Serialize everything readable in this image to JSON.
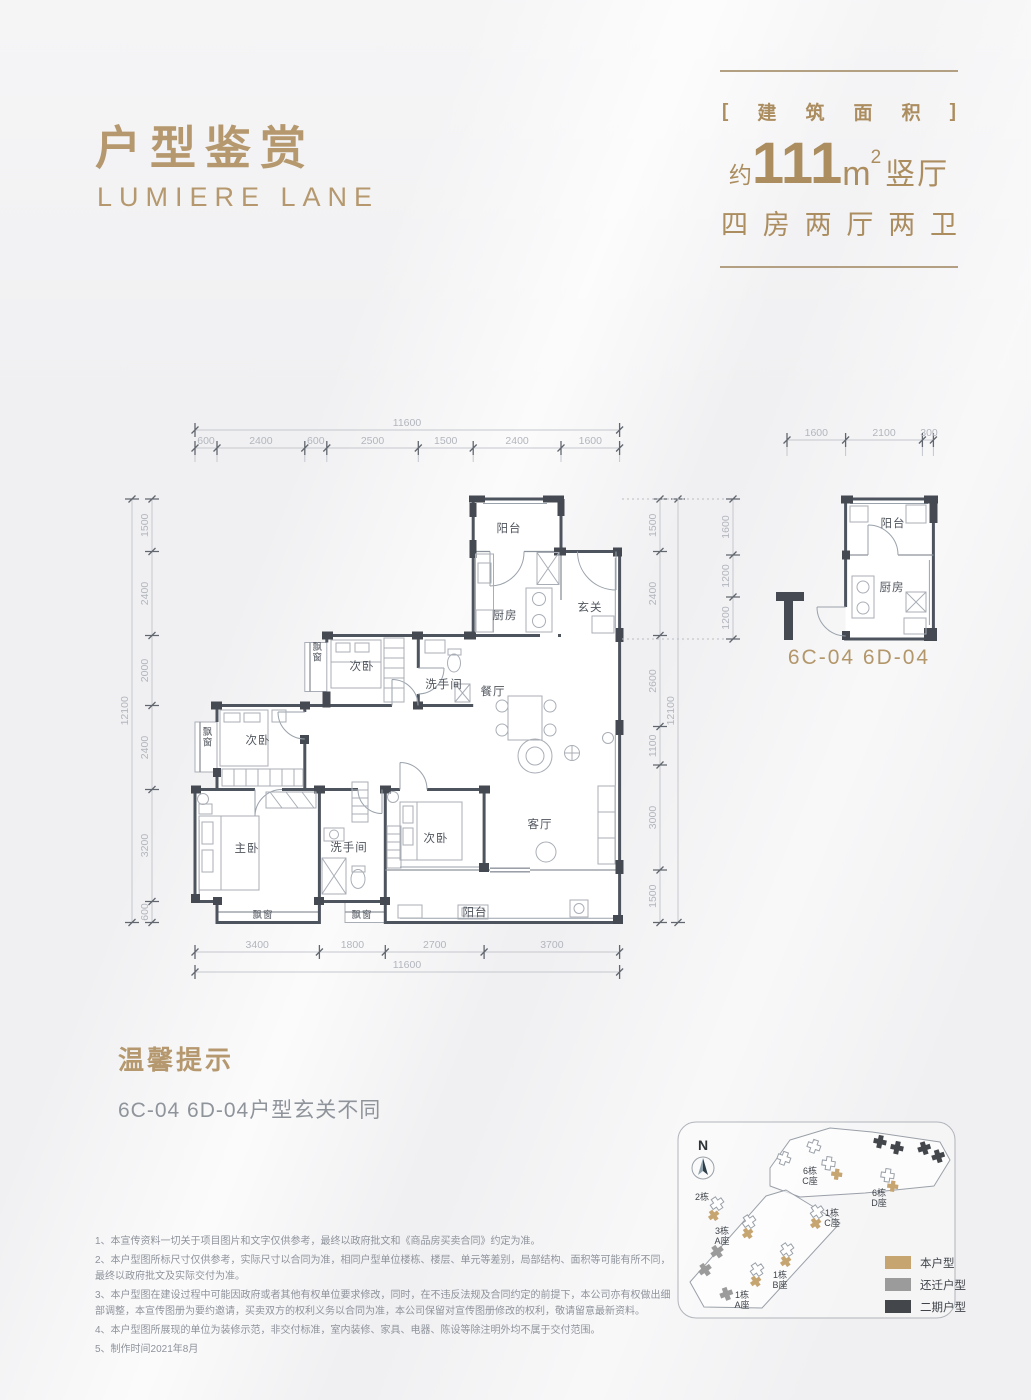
{
  "header": {
    "title": "户型鉴赏",
    "subtitle": "LUMIERE  LANE"
  },
  "info": {
    "bracket_open": "[",
    "bracket_close": "]",
    "area_chars": [
      "建",
      "筑",
      "面",
      "积"
    ],
    "approx": "约",
    "area": "111",
    "unit": "m",
    "sup": "2",
    "hall": "竖厅",
    "layout_chars": [
      "四",
      "房",
      "两",
      "厅",
      "两",
      "卫"
    ]
  },
  "main_plan": {
    "top_total": "11600",
    "top_segs": [
      "600",
      "2400",
      "600",
      "2500",
      "1500",
      "2400",
      "1600"
    ],
    "bottom_total": "11600",
    "bottom_segs": [
      "3400",
      "1800",
      "2700",
      "3700"
    ],
    "left_total": "12100",
    "left_segs": [
      "1500",
      "2400",
      "2000",
      "2400",
      "3200",
      "600"
    ],
    "right_total": "12100",
    "right_segs": [
      "1500",
      "2400",
      "2600",
      "1100",
      "3000",
      "1500"
    ],
    "rooms": {
      "balcony_top": "阳台",
      "kitchen": "厨房",
      "foyer": "玄关",
      "bedroom_upper": "次卧",
      "bay_upper": "飘窗",
      "bath_upper": "洗手间",
      "dining": "餐厅",
      "bedroom_left": "次卧",
      "bay_left": "飘窗",
      "master": "主卧",
      "bath_lower": "洗手间",
      "bedroom_lower": "次卧",
      "living": "客厅",
      "balcony_bottom": "阳台",
      "bay_bottom1": "飘窗",
      "bay_bottom2": "飘窗"
    }
  },
  "small_plan": {
    "top_segs": [
      "1600",
      "2100",
      "300"
    ],
    "left_segs": [
      "1600",
      "1200",
      "1200"
    ],
    "rooms": {
      "balcony": "阳台",
      "kitchen": "厨房"
    },
    "caption": "6C-04  6D-04"
  },
  "tips": {
    "title": "温馨提示",
    "body": "6C-04  6D-04户型玄关不同"
  },
  "notes": [
    "1、本宣传资料一切关于项目图片和文字仅供参考，最终以政府批文和《商品房买卖合同》约定为准。",
    "2、本户型图所标尺寸仅供参考，实际尺寸以合同为准，相同户型单位楼栋、楼层、单元等差别，局部结构、面积等可能有所不同，最终以政府批文及实际交付为准。",
    "3、本户型图在建设过程中可能因政府或者其他有权单位要求修改，同时，在不违反法规及合同约定的前提下，本公司亦有权做出细部调整，本宣传图册为要约邀请，买卖双方的权利义务以合同为准，本公司保留对宣传图册修改的权利，敬请留意最新资料。",
    "4、本户型图所展现的单位为装修示范，非交付标准，室内装修、家具、电器、陈设等除注明外均不属于交付范围。",
    "5、制作时间2021年8月"
  ],
  "sitemap": {
    "north": "N",
    "buildings": {
      "b6c": [
        "6栋",
        "C座"
      ],
      "b6d": [
        "6栋",
        "D座"
      ],
      "b2": "2栋",
      "b1c": [
        "1栋",
        "C座"
      ],
      "b3a": [
        "3栋",
        "A座"
      ],
      "b1b": [
        "1栋",
        "B座"
      ],
      "b1a": [
        "1栋",
        "A座"
      ]
    },
    "legend": [
      {
        "label": "本户型",
        "color": "#c6a571"
      },
      {
        "label": "还迁户型",
        "color": "#9b9b9b"
      },
      {
        "label": "二期户型",
        "color": "#43464b"
      }
    ]
  }
}
